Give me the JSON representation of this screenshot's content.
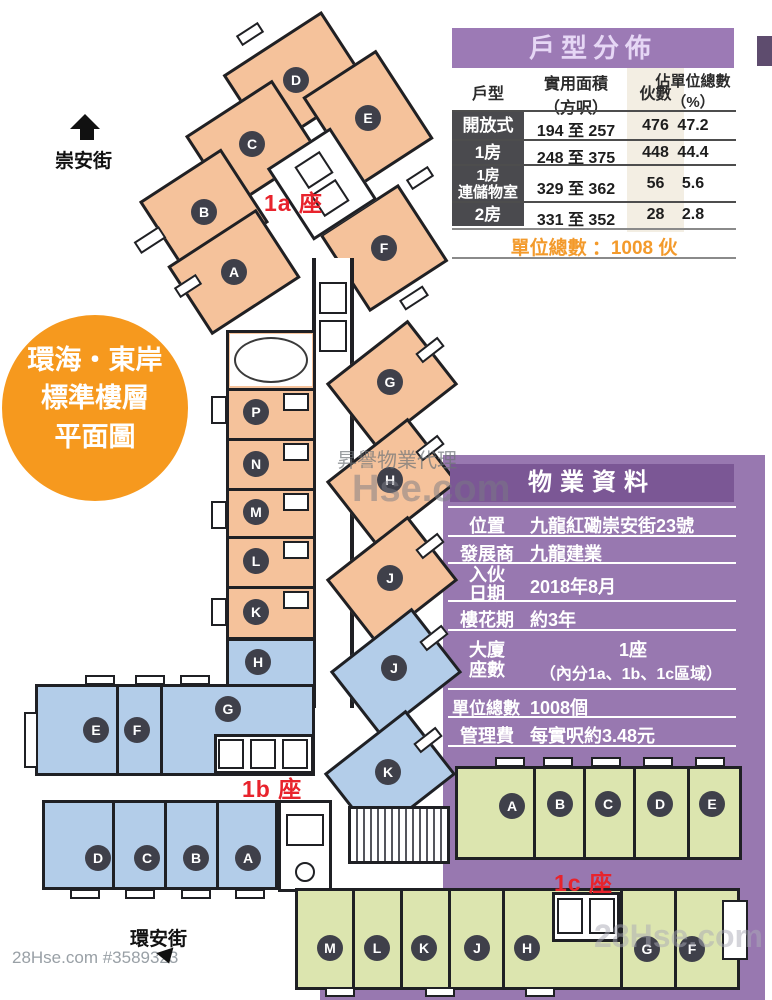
{
  "badge": {
    "line1": "環海・東岸",
    "line2": "標準樓層",
    "line3": "平面圖"
  },
  "streets": {
    "top": "崇安街",
    "bottom": "環安街"
  },
  "towers": {
    "t1a": {
      "label": "1a 座",
      "units": {
        "A": "A",
        "B": "B",
        "C": "C",
        "D": "D",
        "E": "E",
        "F": "F",
        "G": "G",
        "H": "H",
        "J": "J",
        "K": "K",
        "L": "L",
        "M": "M",
        "N": "N",
        "P": "P"
      }
    },
    "t1b": {
      "label": "1b 座",
      "units": {
        "A": "A",
        "B": "B",
        "C": "C",
        "D": "D",
        "E": "E",
        "F": "F",
        "G": "G",
        "H": "H",
        "J": "J",
        "K": "K"
      }
    },
    "t1c": {
      "label": "1c 座",
      "units": {
        "A": "A",
        "B": "B",
        "C": "C",
        "D": "D",
        "E": "E",
        "F": "F",
        "G": "G",
        "H": "H",
        "J": "J",
        "K": "K",
        "L": "L",
        "M": "M"
      }
    }
  },
  "unit_table": {
    "title": "戶型分佈",
    "columns": [
      "戶型",
      "實用面積\n（方呎）",
      "伙數",
      "佔單位總數\n（%）"
    ],
    "rows": [
      {
        "type": "開放式",
        "area": "194 至 257",
        "count": "476",
        "pct": "47.2"
      },
      {
        "type": "1房",
        "area": "248 至 375",
        "count": "448",
        "pct": "44.4"
      },
      {
        "type": "1房\n連儲物室",
        "area": "329 至 362",
        "count": "56",
        "pct": "5.6"
      },
      {
        "type": "2房",
        "area": "331 至 352",
        "count": "28",
        "pct": "2.8"
      }
    ],
    "footer": "單位總數 ：1008 伙"
  },
  "property_table": {
    "title": "物業資料",
    "rows": [
      {
        "label": "位置",
        "value": "九龍紅磡崇安街23號"
      },
      {
        "label": "發展商",
        "value": "九龍建業"
      },
      {
        "label": "入伙\n日期",
        "value": "2018年8月"
      },
      {
        "label": "樓花期",
        "value": "約3年"
      },
      {
        "label": "大廈\n座數",
        "value_line1": "1座",
        "value_line2": "（內分1a、1b、1c區域）"
      },
      {
        "label": "單位總數",
        "value": "1008個"
      },
      {
        "label": "管理費",
        "value": "每實呎約3.48元"
      }
    ]
  },
  "watermarks": {
    "bottom_left": "28Hse.com #3589323",
    "center_line1": "昇譽物業代理",
    "center_line2": "Hse.com",
    "bottom_right": "28Hse.com"
  },
  "colors": {
    "tower_1a": "#F5C29B",
    "tower_1b": "#B3CDE9",
    "tower_1c": "#DCE5AF",
    "panel_purple": "#9878B0",
    "panel_header": "#7B5795",
    "table_title_bg": "#9C7AB5",
    "section_label_red": "#E8232C",
    "badge_orange": "#F6991E",
    "total_orange": "#F39A2B",
    "wall": "#1F2024"
  }
}
